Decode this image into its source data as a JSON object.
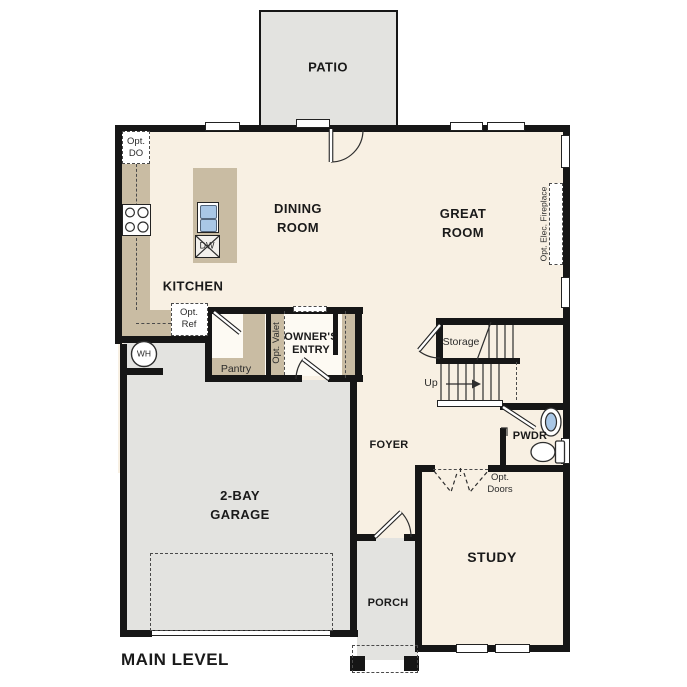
{
  "plan_title": "MAIN LEVEL",
  "labels": {
    "patio": "PATIO",
    "dining_1": "DINING",
    "dining_2": "ROOM",
    "great_1": "GREAT",
    "great_2": "ROOM",
    "kitchen": "KITCHEN",
    "opt_do_1": "Opt.",
    "opt_do_2": "DO",
    "dishwasher": "DW",
    "opt_ref_1": "Opt.",
    "opt_ref_2": "Ref",
    "opt_valet": "Opt. Valet",
    "owners_entry_1": "OWNER'S",
    "owners_entry_2": "ENTRY",
    "pantry": "Pantry",
    "storage": "Storage",
    "up": "Up",
    "water_heater": "WH",
    "garage_1": "2-BAY",
    "garage_2": "GARAGE",
    "foyer": "FOYER",
    "pwdr": "PWDR",
    "opt_doors_1": "Opt.",
    "opt_doors_2": "Doors",
    "study": "STUDY",
    "porch": "PORCH",
    "fireplace": "Opt. Elec. Fireplace"
  },
  "colors": {
    "floor": "#f8f0e3",
    "entry_floor": "#fdfaf3",
    "outdoor": "#e3e3e0",
    "cabinet": "#c9bca3",
    "wall": "#161616",
    "sink_blue": "#a9c7e6",
    "line": "#2e2e2e"
  }
}
